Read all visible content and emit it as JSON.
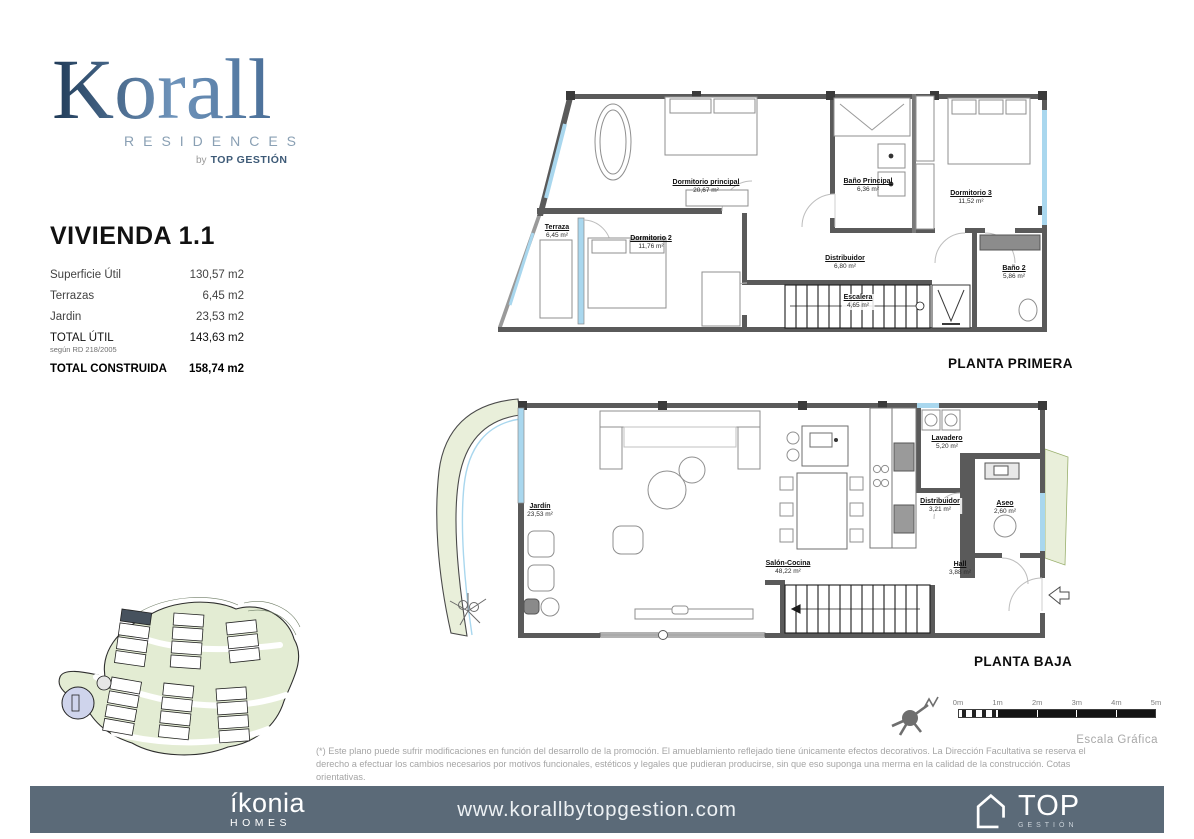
{
  "logo": {
    "name": "Korall",
    "subtitle": "RESIDENCES",
    "by": "by",
    "by_brand": "TOP GESTIÓN"
  },
  "unit": {
    "title": "VIVIENDA 1.1",
    "rows": [
      {
        "label": "Superficie Útil",
        "value": "130,57 m2"
      },
      {
        "label": "Terrazas",
        "value": "6,45 m2"
      },
      {
        "label": "Jardin",
        "value": "23,53 m2"
      },
      {
        "label": "TOTAL ÚTIL",
        "note": "según RD 218/2005",
        "value": "143,63 m2"
      },
      {
        "label": "TOTAL CONSTRUIDA",
        "value": "158,74 m2"
      }
    ]
  },
  "plans": {
    "primera": {
      "caption": "PLANTA PRIMERA",
      "rooms": [
        {
          "name": "Dormitorio principal",
          "area": "20,67 m²"
        },
        {
          "name": "Dormitorio 2",
          "area": "11,76 m²"
        },
        {
          "name": "Dormitorio 3",
          "area": "11,52 m²"
        },
        {
          "name": "Baño Principal",
          "area": "6,36 m²"
        },
        {
          "name": "Baño 2",
          "area": "5,86 m²"
        },
        {
          "name": "Distribuidor",
          "area": "6,80 m²"
        },
        {
          "name": "Terraza",
          "area": "6,45 m²"
        },
        {
          "name": "Escalera",
          "area": "4,65 m²"
        }
      ]
    },
    "baja": {
      "caption": "PLANTA BAJA",
      "rooms": [
        {
          "name": "Jardín",
          "area": "23,53 m²"
        },
        {
          "name": "Salón-Cocina",
          "area": "48,22 m²"
        },
        {
          "name": "Lavadero",
          "area": "5,20 m²"
        },
        {
          "name": "Distribuidor",
          "area": "3,21 m²"
        },
        {
          "name": "Aseo",
          "area": "2,60 m²"
        },
        {
          "name": "Hall",
          "area": "3,88 m²"
        }
      ]
    }
  },
  "scale": {
    "ticks": [
      "0m",
      "1m",
      "2m",
      "3m",
      "4m",
      "5m"
    ],
    "caption": "Escala Gráfica"
  },
  "disclaimer": "(*) Este plano puede sufrir modificaciones en función del desarrollo de la promoción. El amueblamiento reflejado tiene únicamente efectos decorativos. La Dirección Facultativa se reserva el derecho a efectuar los cambios necesarios por motivos funcionales, estéticos y legales que pudieran producirse, sin que eso suponga una merma en la calidad de la construcción. Cotas orientativas.",
  "footer": {
    "brand": "íkonia",
    "brand_sub": "HOMES",
    "website": "www.korallbytopgestion.com",
    "partner": "TOP",
    "partner_sub": "GESTIÓN"
  },
  "colors": {
    "accent_navy": "#3d5a77",
    "footer_bar": "#5b6a78",
    "window_blue": "#a9d7ee",
    "site_green": "#e3ecd3",
    "highlight_unit": "#47525e"
  }
}
